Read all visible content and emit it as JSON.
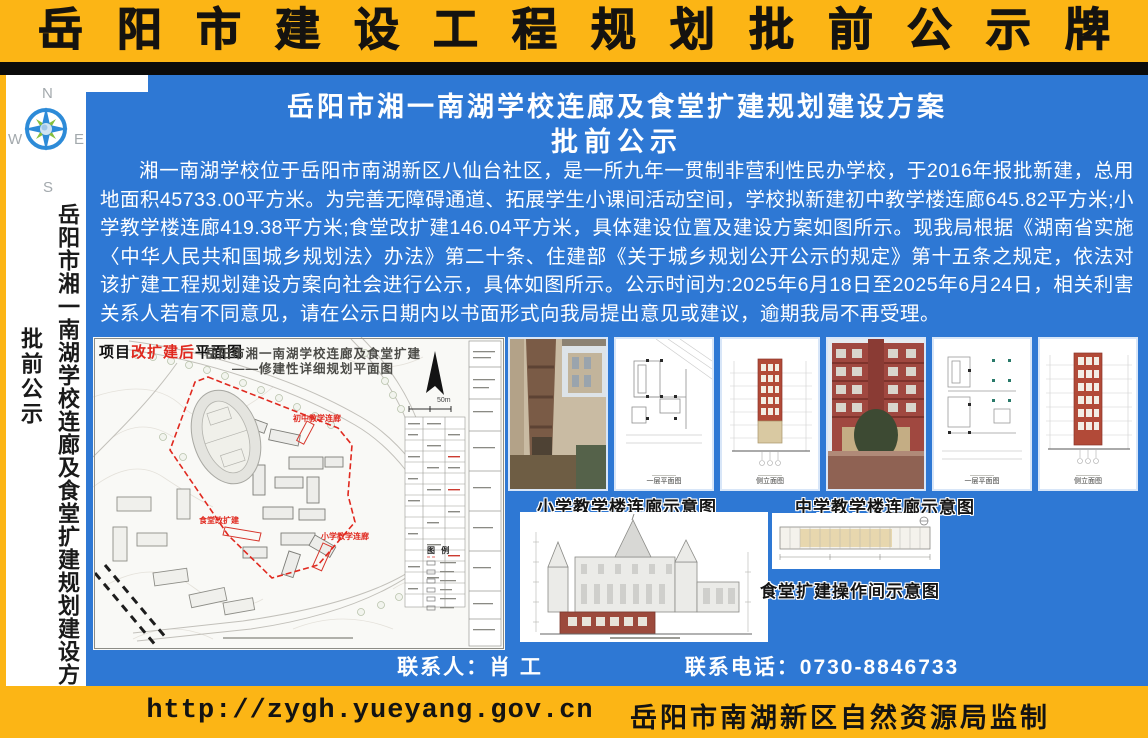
{
  "colors": {
    "yellow": "#fcb515",
    "blue": "#2e78d4",
    "black_bar": "#0b0b0b",
    "red": "#e0291f",
    "white": "#ffffff"
  },
  "header": {
    "title": "岳阳市建设工程规划批前公示牌"
  },
  "sidebar": {
    "compass": {
      "north": "N",
      "south": "S",
      "east": "E",
      "west": "W"
    },
    "project_title": "岳阳市湘一南湖学校连廊及食堂扩建规划建设方案",
    "stage_label": "批前公示"
  },
  "notice": {
    "title": "岳阳市湘一南湖学校连廊及食堂扩建规划建设方案",
    "subtitle": "批前公示",
    "body": "湘一南湖学校位于岳阳市南湖新区八仙台社区，是一所九年一贯制非营利性民办学校，于2016年报批新建，总用地面积45733.00平方米。为完善无障碍通道、拓展学生小课间活动空间，学校拟新建初中教学楼连廊645.82平方米;小学教学楼连廊419.38平方米;食堂改扩建146.04平方米，具体建设位置及建设方案如图所示。现我局根据《湖南省实施〈中华人民共和国城乡规划法〉办法》第二十条、住建部《关于城乡规划公开公示的规定》第十五条之规定，依法对该扩建工程规划建设方案向社会进行公示，具体如图所示。公示时间为:2025年6月18日至2025年6月24日，相关利害关系人若有不同意见，请在公示日期内以书面形式向我局提出意见或建议，逾期我局不再受理。"
  },
  "site_plan": {
    "corner_label": {
      "prefix": "项目",
      "highlight": "改扩建后",
      "suffix": "平面图"
    },
    "title_line1": "岳阳市湘一南湖学校连廊及食堂扩建",
    "title_line2": "——修建性详细规划平面图",
    "labels": {
      "middle_corridor": "初中教学连廊",
      "canteen": "食堂改扩建",
      "primary_corridor": "小学教学连廊"
    },
    "scale": "50m",
    "legend_title": "图 例"
  },
  "gallery": {
    "tiles": [
      {
        "kind": "photo"
      },
      {
        "kind": "plan",
        "caption": "一层平面图"
      },
      {
        "kind": "elevation",
        "caption": "侧立面图"
      },
      {
        "kind": "photo"
      },
      {
        "kind": "plan",
        "caption": "一层平面图"
      },
      {
        "kind": "elevation",
        "caption": "侧立面图"
      }
    ],
    "caption_primary": "小学教学楼连廊示意图",
    "caption_middle": "中学教学楼连廊示意图",
    "caption_canteen": "食堂扩建操作间示意图"
  },
  "contact": {
    "person": "联系人：肖  工",
    "phone": "联系电话：0730-8846733"
  },
  "footer": {
    "url": "http://zygh.yueyang.gov.cn",
    "issuer": "岳阳市南湖新区自然资源局监制"
  }
}
